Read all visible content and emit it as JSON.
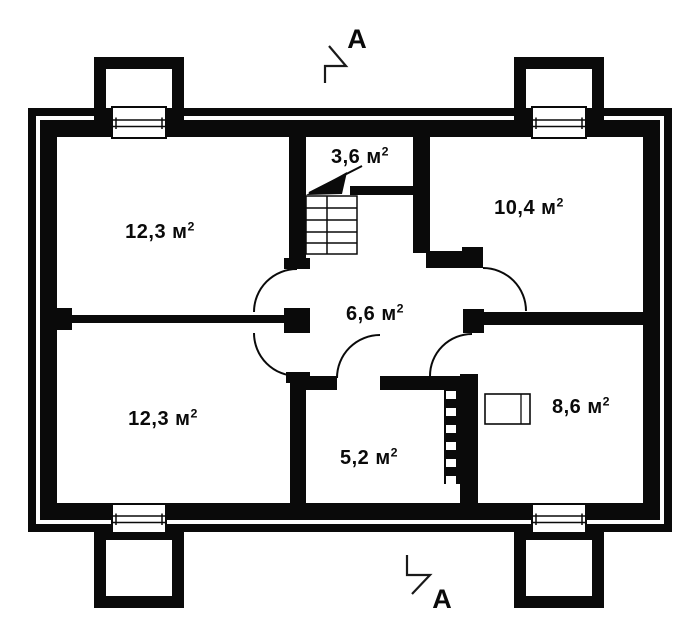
{
  "document": {
    "kind": "architectural-floor-plan"
  },
  "rooms": {
    "top_left": {
      "label": "12,3 м",
      "sup": "2"
    },
    "staircase": {
      "label": "3,6 м",
      "sup": "2"
    },
    "top_right": {
      "label": "10,4 м",
      "sup": "2"
    },
    "hall": {
      "label": "6,6 м",
      "sup": "2"
    },
    "bottom_left": {
      "label": "12,3 м",
      "sup": "2"
    },
    "bottom_middle": {
      "label": "5,2 м",
      "sup": "2"
    },
    "bottom_right": {
      "label": "8,6 м",
      "sup": "2"
    }
  },
  "section_markers": {
    "top_label": "A",
    "bottom_label": "A"
  },
  "colors": {
    "wall": "#0a0a0a",
    "background": "#ffffff"
  },
  "symbols": {
    "stairs": "stairs-with-up-arrow",
    "doors": "door-swing-arc",
    "windows": "window-with-sash",
    "ladder": "wall-ladder",
    "appliance": "washing-machine"
  }
}
